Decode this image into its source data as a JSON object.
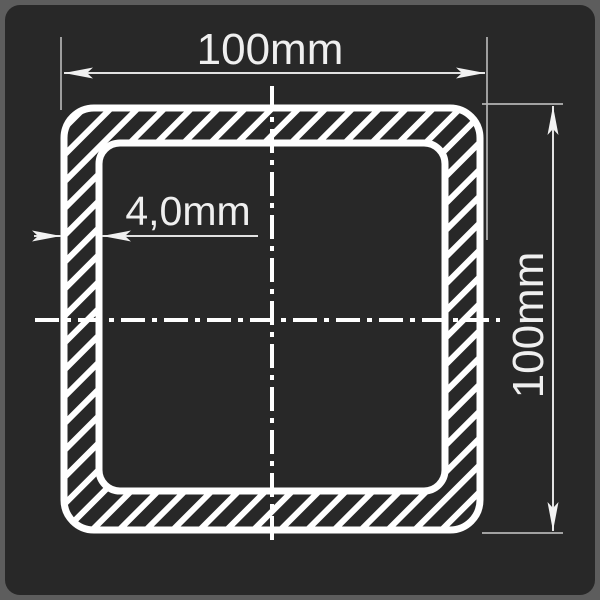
{
  "drawing": {
    "type": "technical-cross-section",
    "subject": "square hollow tube profile with hatched wall section",
    "labels": {
      "top_width": "100mm",
      "right_height": "100mm",
      "wall_thickness": "4,0mm"
    },
    "colors": {
      "frame_background": "#5d5d5d",
      "panel_background": "#282828",
      "profile_line": "#ffffff",
      "dimension_line": "#e2e2e2",
      "extension_line": "#b4b4b4",
      "label_text": "#efefef"
    }
  }
}
